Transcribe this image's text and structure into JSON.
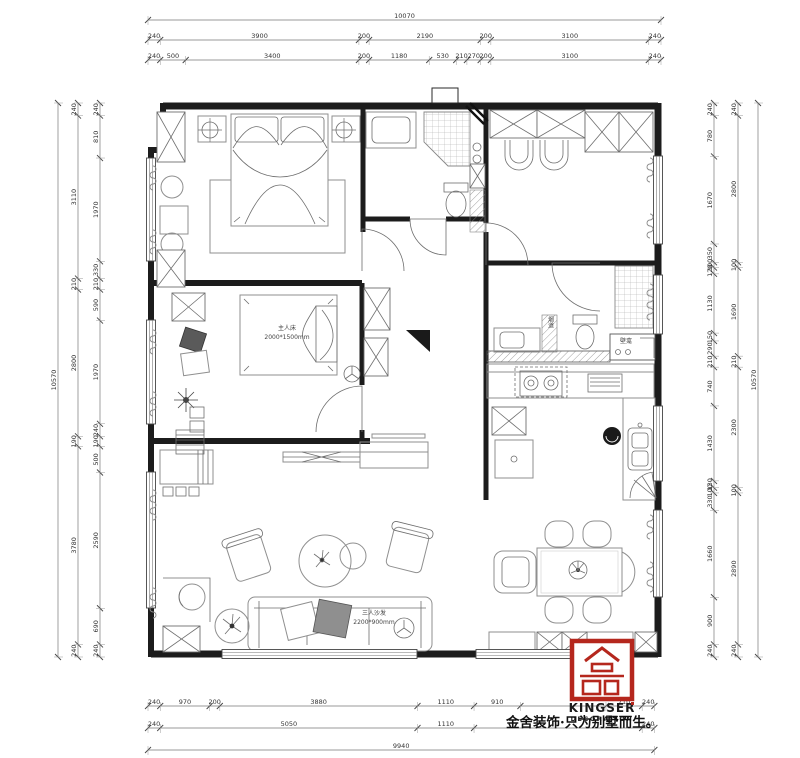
{
  "branding": {
    "logo_name": "KINGSER",
    "logo_sub": "DECORATION",
    "slogan": "金舍装饰·只为别墅而生。"
  },
  "labels": {
    "bed2_l1": "主人床",
    "bed2_l2": "2000*1500mm",
    "sofa_l1": "三人沙发",
    "sofa_l2": "2200*900mm",
    "niche": "壁龛",
    "flue": "烟道"
  },
  "dims": {
    "top_overall": "10070",
    "top_row2": [
      "240",
      "3900",
      "200",
      "2190",
      "200",
      "3100",
      "240"
    ],
    "top_row3": [
      "240",
      "500",
      "3400",
      "200",
      "1180",
      "530",
      "210",
      "270",
      "200",
      "3100",
      "240"
    ],
    "bottom_row1": [
      "240",
      "970",
      "200",
      "3880",
      "1110",
      "910",
      "",
      "710",
      "240"
    ],
    "bottom_row2": [
      "240",
      "5050",
      "1110",
      "",
      "240"
    ],
    "bottom_overall": "9940",
    "left_overall": "10570",
    "left_outer": [
      "240",
      "3110",
      "210",
      "2800",
      "190",
      "3780",
      "240"
    ],
    "left_inner": [
      "240",
      "810",
      "1970",
      "330",
      "210",
      "590",
      "1970",
      "240",
      "190",
      "500",
      "2590",
      "690",
      "240"
    ],
    "right_inner": [
      "240",
      "780",
      "1670",
      "350",
      "100",
      "120",
      "1130",
      "150",
      "290",
      "210",
      "740",
      "1430",
      "130",
      "100",
      "330",
      "1660",
      "900",
      "240"
    ],
    "right_outer": [
      "240",
      "2800",
      "100",
      "1690",
      "210",
      "2300",
      "100",
      "2890",
      "240"
    ],
    "right_overall": "10570"
  }
}
